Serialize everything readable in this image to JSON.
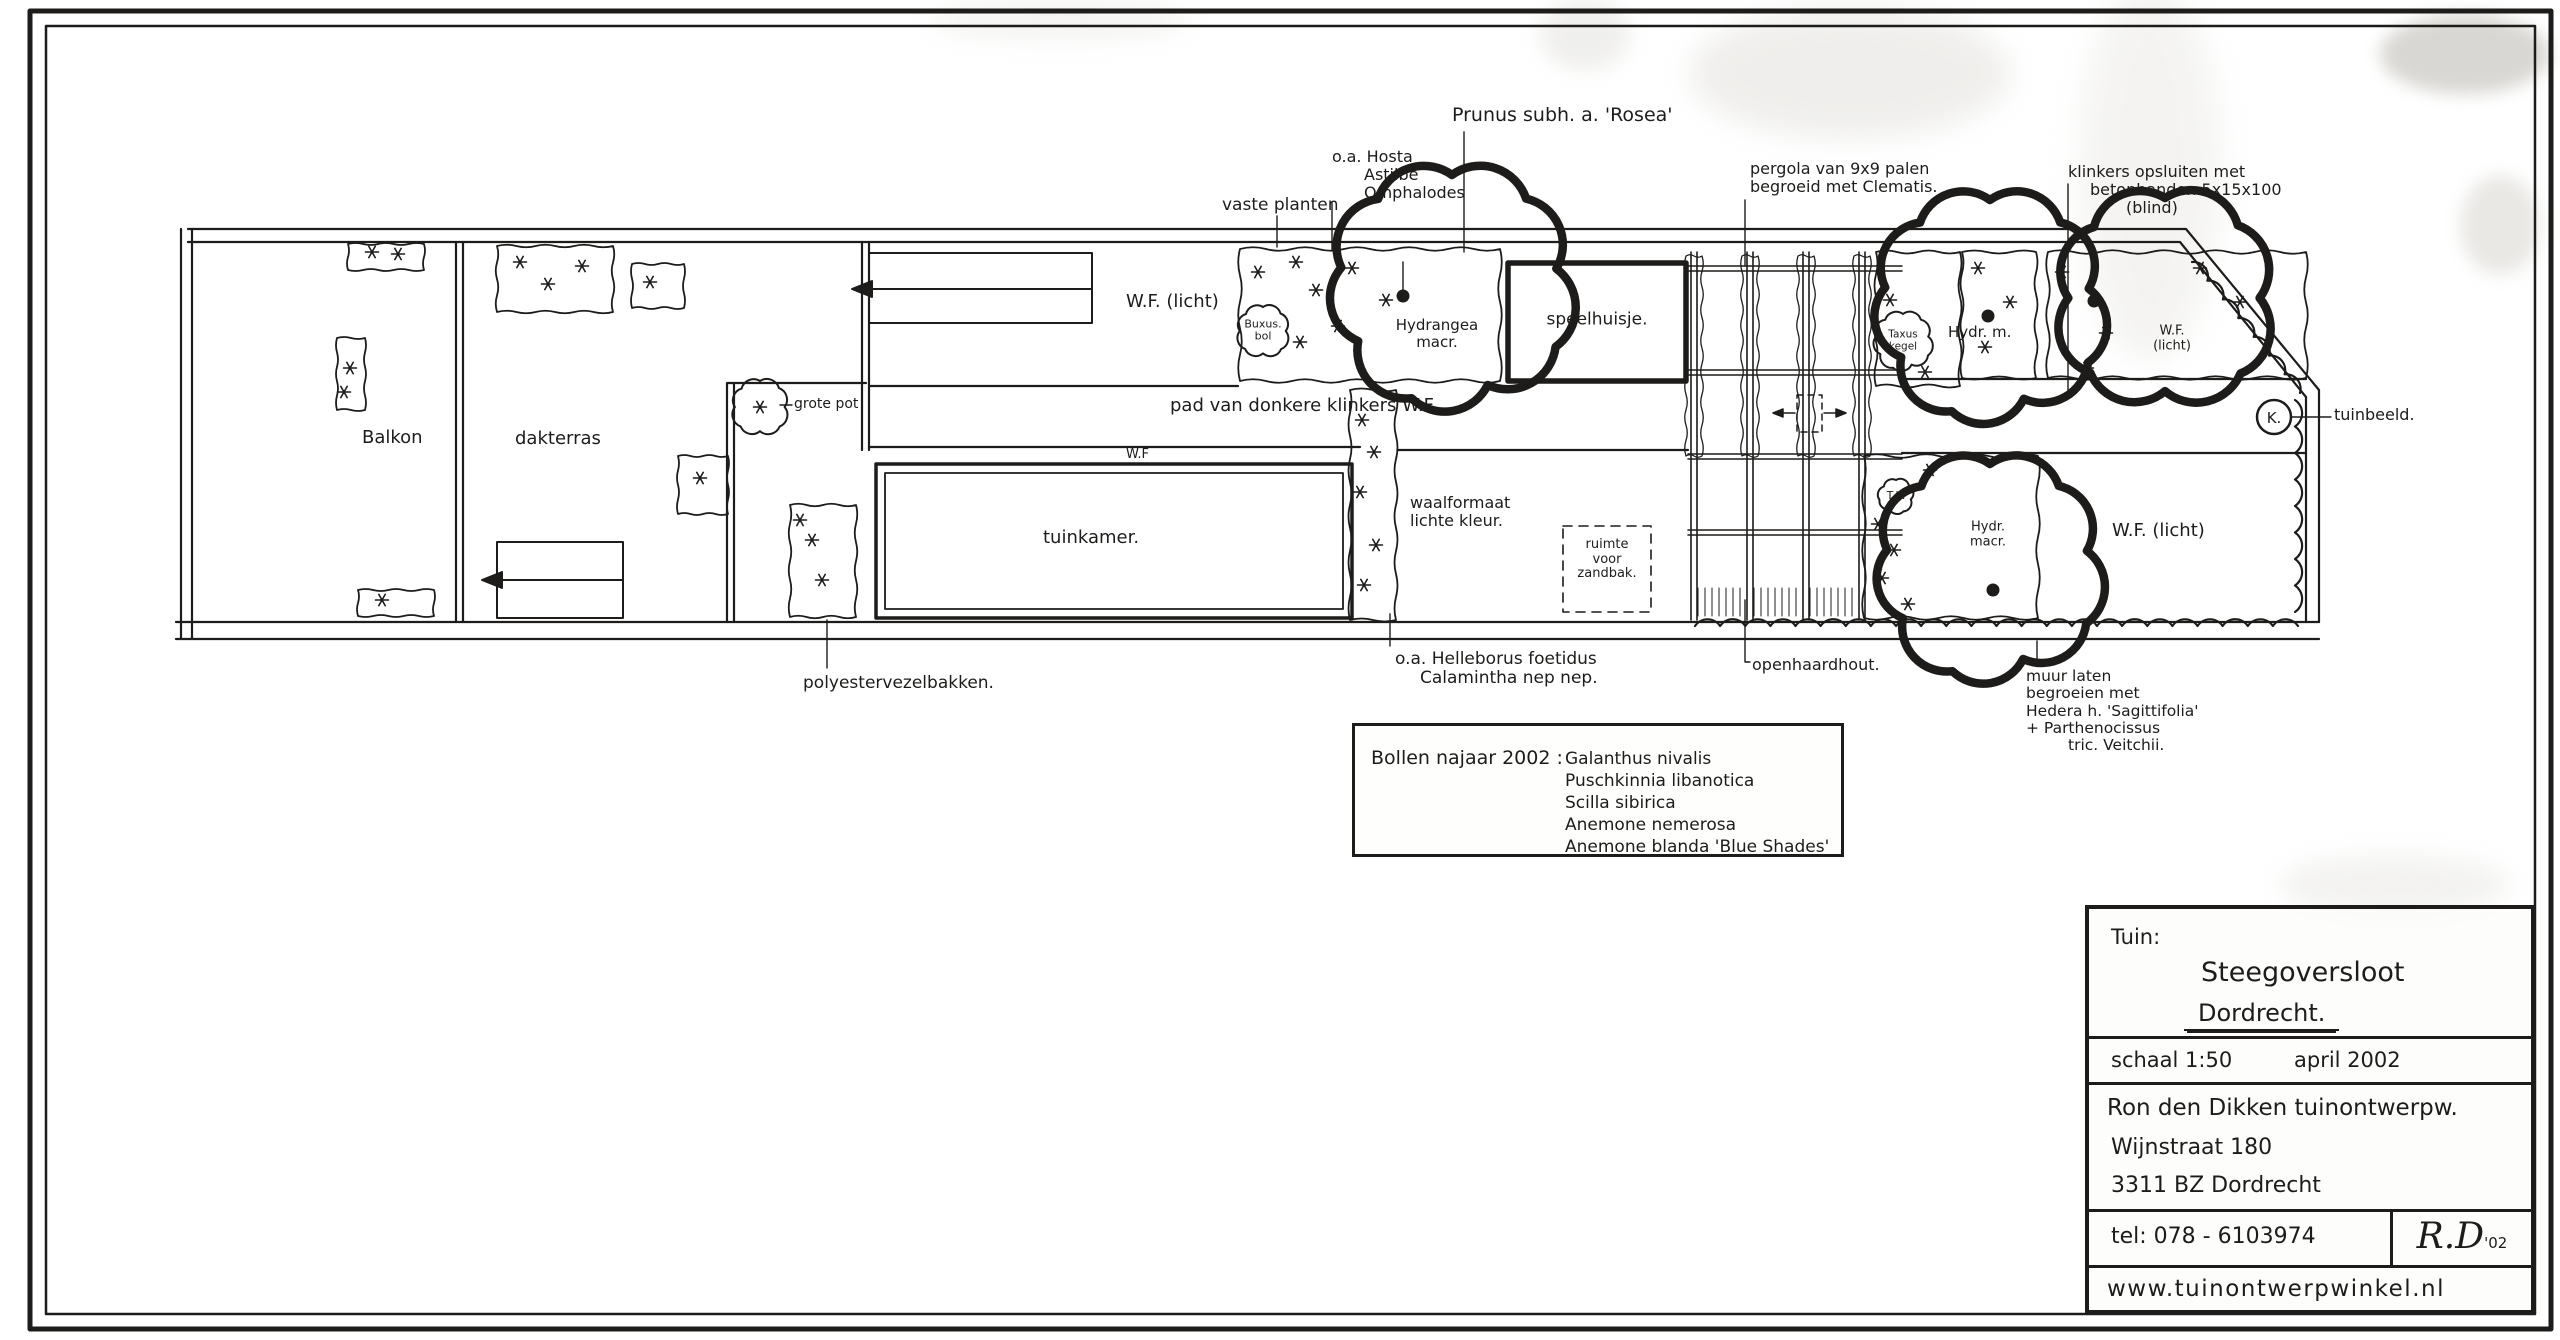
{
  "ink": "#1d1c1a",
  "paper": "#fcfcfa",
  "title_block": {
    "label": "Tuin:",
    "project": "Steegoversloot",
    "city": "Dordrecht.",
    "scale": "schaal 1:50",
    "date": "april 2002",
    "designer": "Ron den Dikken tuinontwerpw.",
    "street": "Wijnstraat 180",
    "postal": "3311 BZ Dordrecht",
    "tel": "tel: 078 - 6103974",
    "monogram": "R.D",
    "monogram_year": "'02",
    "website": "www.tuinontwerpwinkel.nl"
  },
  "legend": {
    "heading": "Bollen najaar 2002 :",
    "bulbs": [
      "Galanthus nivalis",
      "Puschkinnia libanotica",
      "Scilla sibirica",
      "Anemone nemerosa",
      "Anemone blanda 'Blue Shades'"
    ]
  },
  "plan": {
    "labels": {
      "prunus": "Prunus subh. a. 'Rosea'",
      "hosta_lines": [
        "o.a. Hosta",
        "Astilbe",
        "Omphalodes"
      ],
      "vaste_planten": "vaste planten",
      "pergola_lines": [
        "pergola van 9x9 palen",
        "begroeid met Clematis."
      ],
      "klinkers_lines": [
        "klinkers opsluiten met",
        "betonbanden 5x15x100",
        "(blind)"
      ],
      "wf_licht_left": "W.F. (licht)",
      "buxus_lines": [
        "Buxus.",
        "bol"
      ],
      "hydrangea_lines": [
        "Hydrangea",
        "macr."
      ],
      "speelhuisje": "speelhuisje.",
      "taxus_lines": [
        "Taxus",
        "kegel"
      ],
      "hydr_m": "Hydr. m.",
      "wf_licht_small_lines": [
        "W.F.",
        "(licht)"
      ],
      "grote_pot": "grote pot",
      "pad": "pad van donkere klinkers   W.F.",
      "wf_strip": "W.F",
      "balkon": "Balkon",
      "dakterras": "dakterras",
      "tuinkamer": "tuinkamer.",
      "waalformaat_lines": [
        "waalformaat",
        "lichte kleur."
      ],
      "zandbak_lines": [
        "ruimte",
        "voor",
        "zandbak."
      ],
      "tk": "T.k.",
      "hydr_macr_lines": [
        "Hydr.",
        "macr."
      ],
      "wf_licht_right": "W.F. (licht)",
      "k_marker": "K.",
      "tuinbeeld": "tuinbeeld.",
      "helleborus_lines": [
        "o.a. Helleborus foetidus",
        "Calamintha nep nep."
      ],
      "openhaardhout": "openhaardhout.",
      "muur_lines": [
        "muur laten",
        "begroeien met",
        "Hedera h. 'Sagittifolia'",
        "+ Parthenocissus",
        "tric. Veitchii."
      ],
      "polyester": "polyestervezelbakken."
    }
  }
}
